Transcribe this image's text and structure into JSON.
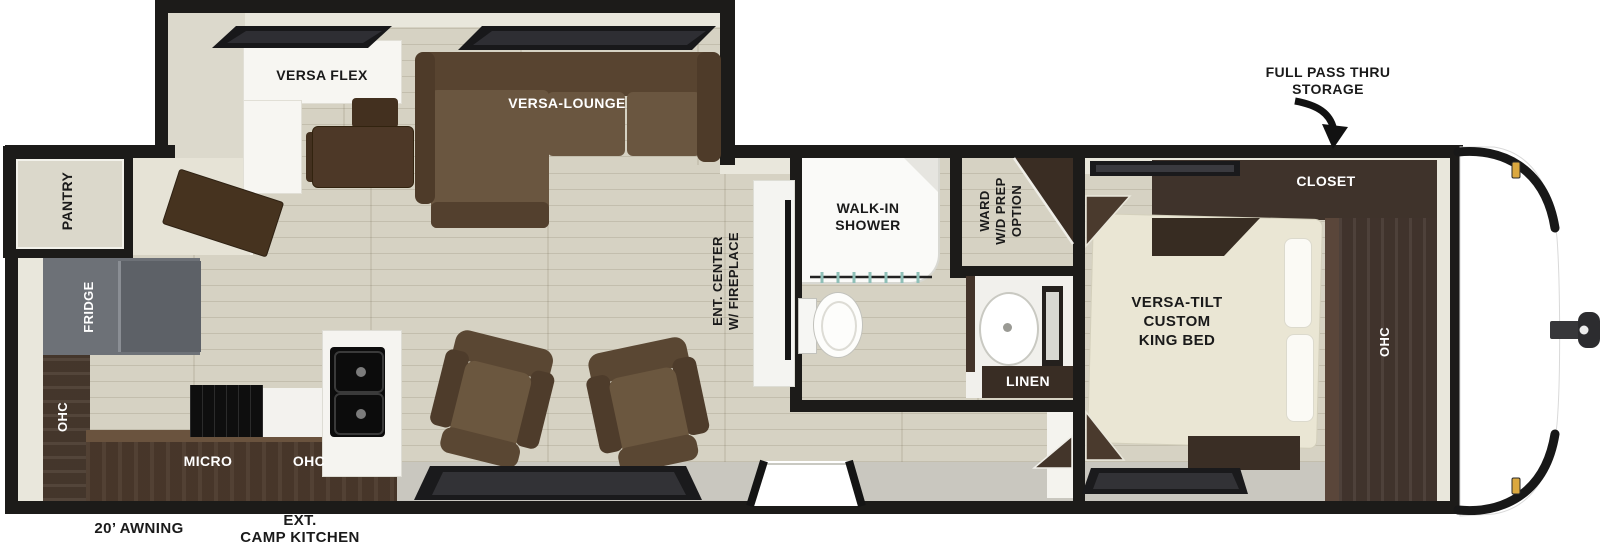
{
  "floorplan": {
    "labels": {
      "full_pass_thru": "FULL PASS THRU\nSTORAGE",
      "closet": "CLOSET",
      "king_bed": "VERSA-TILT\nCUSTOM\nKING BED",
      "ohc_bedroom": "OHC",
      "walk_in_shower": "WALK-IN\nSHOWER",
      "ward_wd": "WARD\nW/D PREP\nOPTION",
      "linen": "LINEN",
      "ent_center": "ENT. CENTER\nW/ FIREPLACE",
      "versa_lounge": "VERSA-LOUNGE",
      "versa_flex": "VERSA FLEX",
      "pantry": "PANTRY",
      "fridge": "FRIDGE",
      "ohc_left": "OHC",
      "micro": "MICRO",
      "ohc_kitchen": "OHC",
      "awning": "20’ AWNING",
      "ext_camp_kitchen": "EXT.\nCAMP KITCHEN"
    },
    "colors": {
      "wall": "#1c1b19",
      "floor_wood": "#d6d2c3",
      "walkway_gray": "#c9c7bf",
      "cabinet_dark_brown": "#453730",
      "sofa_brown": "#6a5640",
      "fridge_gray": "#6d7177",
      "bed_cream": "#eae6d4",
      "marker_light_amber": "#dba83f",
      "exterior_white": "#ffffff"
    }
  }
}
